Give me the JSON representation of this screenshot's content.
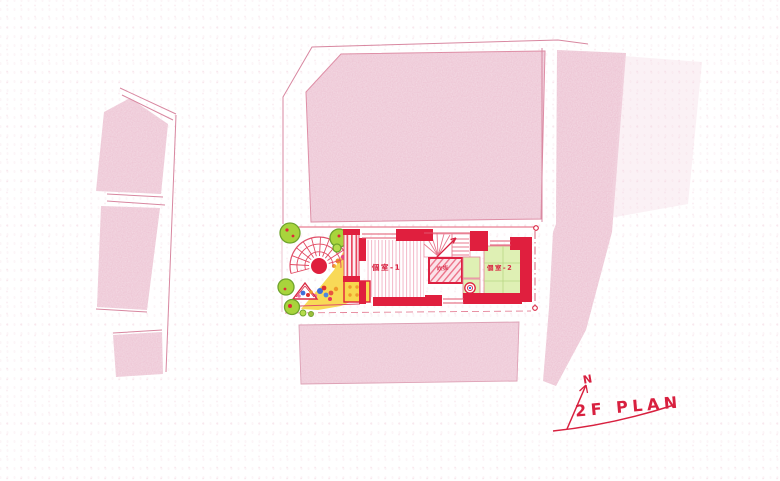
{
  "drawing": {
    "plan_title": "2F PLAN",
    "north_label": "N",
    "rooms": [
      {
        "label": "個室-1"
      },
      {
        "label": "個室-2"
      }
    ],
    "void_label": "吹抜",
    "colors": {
      "ink_red": "#d8203f",
      "wall_red": "#e01f3e",
      "pencil_pink": "#f0cfdc",
      "terrace_yellow": "#f8d74e",
      "tree_green": "#a8d43c",
      "tatami_green": "#dff0b4",
      "paper": "#ffffff"
    }
  }
}
